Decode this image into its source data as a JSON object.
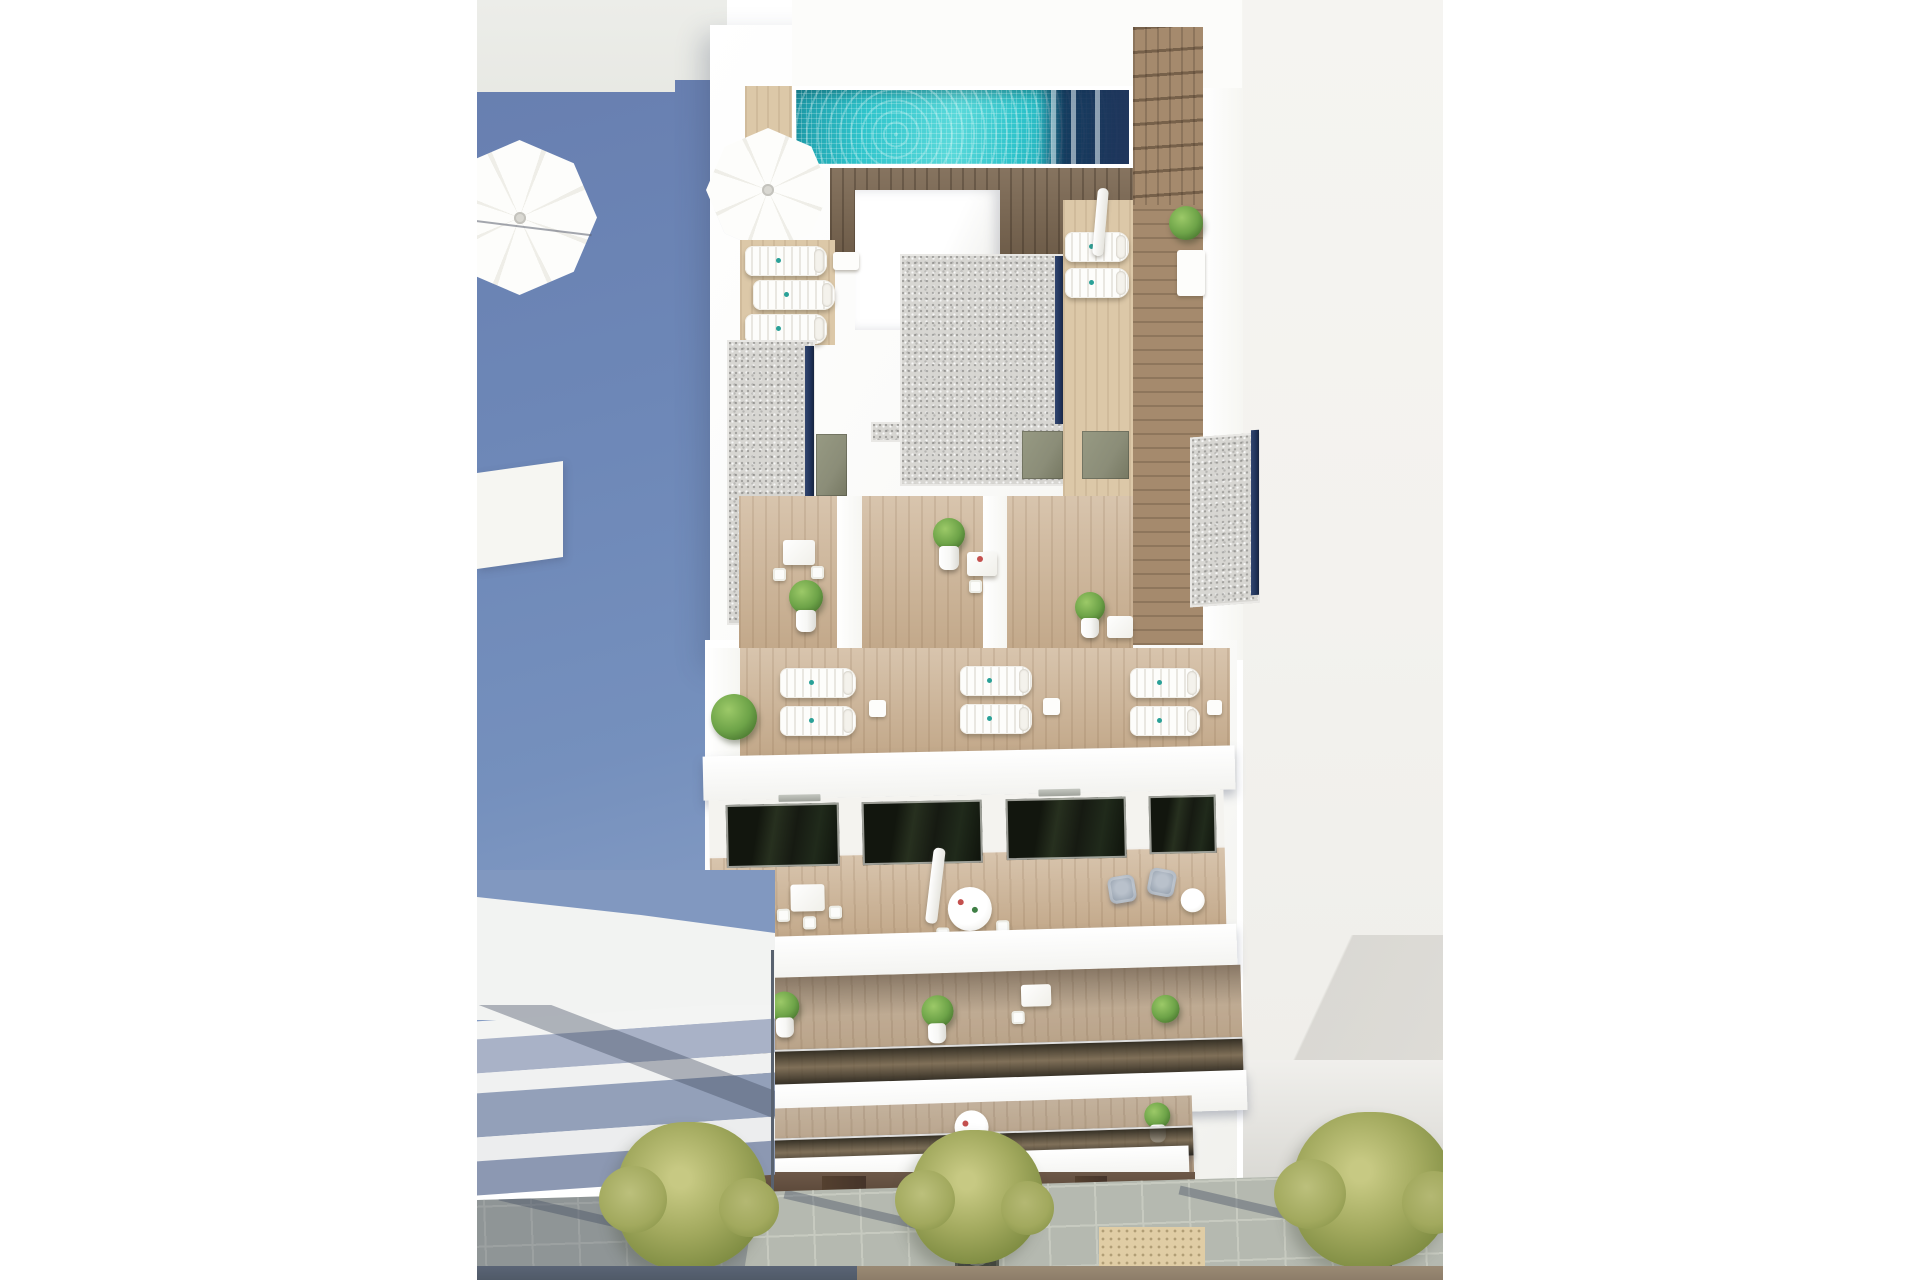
{
  "meta": {
    "title": "Aerial 3D architectural rendering of a residential apartment building",
    "description": "Top-down render showing a rooftop terrace with swimming pool, parasols and sun loungers, stepped gravel roofs with skylights, wooden private terraces, four balcony levels with outdoor furniture, neighbouring white buildings casting a large blue shadow, and a paved sidewalk with street trees below."
  },
  "scene": {
    "labels": {
      "render": "aerial building render",
      "pool": "rooftop swimming pool",
      "pool_deck": "rooftop pool deck",
      "parasol_main": "white parasol",
      "parasol_neighbour": "neighbouring rooftop parasol",
      "loungers": "sun loungers",
      "gravel_roof": "gravel roof with skylight strip",
      "terraces": "private wooden terraces",
      "terrace_door": "terrace access door",
      "lounger_terrace": "lounger terrace level",
      "balconies": "stacked balconies with furniture",
      "glass_balustrade": "tinted glass balustrade",
      "armchairs": "grey outdoor armchairs",
      "dining_set": "white outdoor dining set",
      "plant": "potted plant",
      "blue_shadow": "building shadow on neighbouring roof",
      "neighbour_left": "neighbouring building balconies",
      "neighbour_right": "neighbouring rooftop",
      "ground_floor": "shaded ground-floor storefront",
      "sidewalk": "stone paved sidewalk",
      "tree": "street tree with metal grate",
      "tactile": "tactile paving strip",
      "road": "road edge"
    },
    "counts": {
      "street_trees": 3,
      "balcony_levels": 4,
      "rooftop_lounger_pairs": 3,
      "gravel_roof_blocks": 3,
      "parasols": 2
    }
  },
  "palette": {
    "page_bg": "#ffffff",
    "roof_grey": "#ecede9",
    "shadow_blue": "#6d87b7",
    "right_roof": "#f3f2ee",
    "right_roof_shade": "#dedcd7",
    "building_white": "#fafaf8",
    "pool_teal": "#2fc4cb",
    "pool_teal_light": "#5ad9da",
    "pool_teal_dark": "#1b96a4",
    "pool_reflection": "#20365c",
    "pool_deck": "#e8d9bd",
    "deck_dark": "#7c6852",
    "wood_mid": "#a58a6d",
    "wood_light": "#cbb192",
    "wood_pale": "#dcc8a8",
    "gravel": "#d7d6d2",
    "skylight_navy": "#20335a",
    "door_olive": "#8b8d78",
    "glass_dark": "#161a12",
    "plant_green": "#6da348",
    "plant_dark": "#44702c",
    "pot_white": "#f7f7f5",
    "tree_green": "#a2a95e",
    "tree_dark": "#7c8a40",
    "pavement": "#b5b9b0",
    "pavement_line": "#c9ccc3",
    "grate_dark": "#42453f",
    "tactile": "#e0cda5",
    "road_left": "#505a68",
    "road_right": "#8d7d69",
    "ground_brown": "#5e4b3c",
    "ground_door": "#45342a",
    "neigh_band1": "#a9b2c7",
    "neigh_band2": "#93a0b9",
    "armchair": "#98a3b0",
    "umbrella_white": "#fdfdfb",
    "red_accent": "#c4504e",
    "shadow_soft": "rgba(60,70,92,0.38)"
  }
}
